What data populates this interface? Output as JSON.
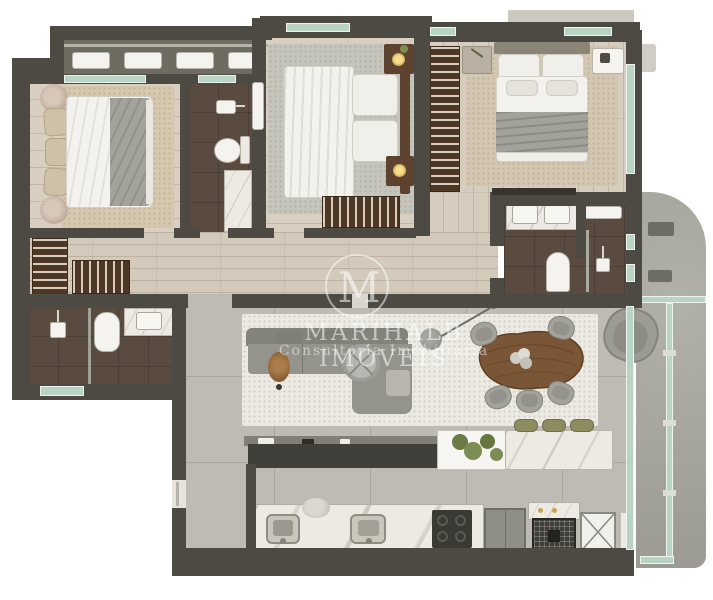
{
  "watermark": {
    "monogram": "M",
    "line1": "MARIHALB IMÓVEIS",
    "line2": "Consultoria Imobiliária"
  },
  "palette": {
    "wall": "#4c4a43",
    "wood_floor": "#d8cfc0",
    "hall_floor": "#d4cabb",
    "bath_floor": "#594b3f",
    "rug_beige": "#d5c8ae",
    "rug_gray": "#c6c5bc",
    "rug_living": "#eceae3",
    "concrete_floor": "#bdbbb3",
    "balcony_concrete": "#a8a8a0",
    "glass_green": "#b9d4c4",
    "marble": "#eceae3",
    "sofa_gray": "#94938c",
    "furniture_wood": "#7a5637",
    "slat_wood": "#4f3726",
    "white_fixture": "#f4f3ef",
    "stool_green": "#8d8c5e",
    "grill_black": "#3f3e38",
    "lamp_glow": "#f6dd8c"
  },
  "floorplan": {
    "rooms": [
      {
        "name": "technical-balcony",
        "furniture": [
          "ac-unit",
          "ac-unit",
          "ac-unit",
          "ac-unit"
        ]
      },
      {
        "name": "bedroom-1",
        "furniture": [
          "double-bed",
          "headboard-cushions",
          "pouf",
          "pouf",
          "beige-rug"
        ]
      },
      {
        "name": "bathroom-1",
        "furniture": [
          "washbasin",
          "toilet",
          "marble-shower",
          "wall-shelf"
        ]
      },
      {
        "name": "dressing-area",
        "furniture": [
          "slatted-bench",
          "slatted-bench"
        ]
      },
      {
        "name": "bedroom-2",
        "furniture": [
          "double-bed",
          "nightstand-with-lamp",
          "nightstand-with-lamp",
          "slatted-bench",
          "gray-rug"
        ]
      },
      {
        "name": "wardrobe-corridor",
        "furniture": [
          "slatted-wardrobe-rack"
        ]
      },
      {
        "name": "bedroom-3",
        "furniture": [
          "double-bed",
          "nightstand",
          "nightstand-with-lamp",
          "tv-panel",
          "beige-rug"
        ]
      },
      {
        "name": "master-bathroom",
        "furniture": [
          "double-washbasin-vanity",
          "wall-shelf",
          "toilet",
          "shower-valve",
          "glass-partition"
        ]
      },
      {
        "name": "bathroom-2",
        "furniture": [
          "shower-head",
          "toilet",
          "washbasin-vanity",
          "glass-door"
        ]
      },
      {
        "name": "hallway",
        "furniture": []
      },
      {
        "name": "living-room",
        "furniture": [
          "sectional-sofa",
          "round-coffee-table",
          "wood-side-stool",
          "arc-floor-lamp",
          "cream-rug",
          "tv-console"
        ]
      },
      {
        "name": "dining-area",
        "furniture": [
          "organic-wood-table",
          "flower-centerpiece",
          "dining-chair",
          "dining-chair",
          "dining-chair",
          "dining-chair",
          "dining-chair",
          "lounge-armchair"
        ]
      },
      {
        "name": "kitchen",
        "furniture": [
          "island-planter",
          "marble-island",
          "bar-stool",
          "bar-stool",
          "bar-stool",
          "double-sink-counter",
          "stone-bowl",
          "cooktop",
          "refrigerator",
          "charcoal-grill",
          "service-shaft"
        ]
      },
      {
        "name": "service-area",
        "furniture": []
      },
      {
        "name": "balcony",
        "furniture": [
          "planter-bench",
          "planter-bench",
          "glass-railing"
        ]
      }
    ]
  }
}
